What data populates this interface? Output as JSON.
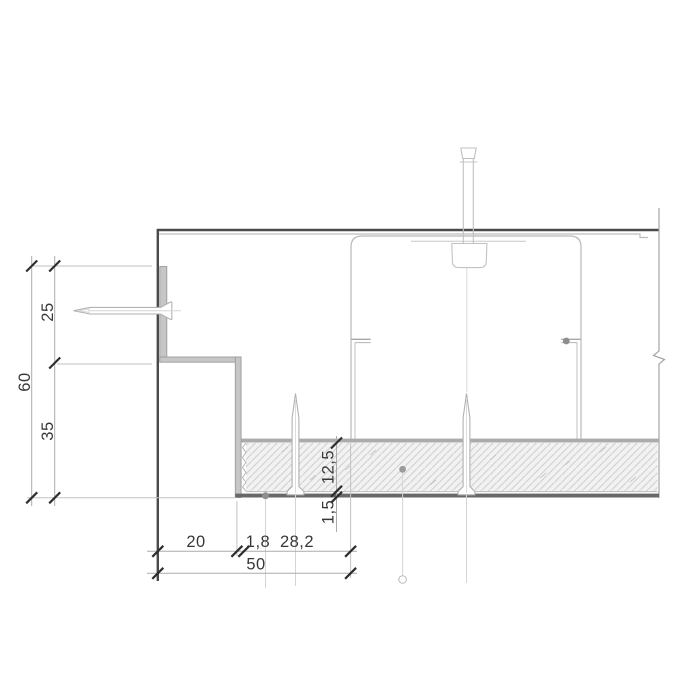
{
  "drawing": {
    "kind": "suspended-ceiling-edge-detail-section",
    "colors": {
      "line_dark": "#4a4a4a",
      "line_light": "#b9b9b9",
      "profile_fill": "#c6c6c6",
      "profile_edge": "#9c9c9c",
      "flange_dark": "#686868",
      "furring_band": "#ababab",
      "hatch_line": "#cdcdcd",
      "board_fill": "#f2f2f2",
      "dim_line": "#ababab",
      "dim_tick": "#2e2e2e",
      "dim_text": "#383838"
    },
    "dims": {
      "h_total": "60",
      "h_upper": "25",
      "h_lower": "35",
      "w_wall_to_profile": "20",
      "w_gap": "1,8",
      "w_board": "28,2",
      "w_total": "50",
      "board_thickness": "12,5",
      "flange_thickness": "1,5"
    }
  }
}
